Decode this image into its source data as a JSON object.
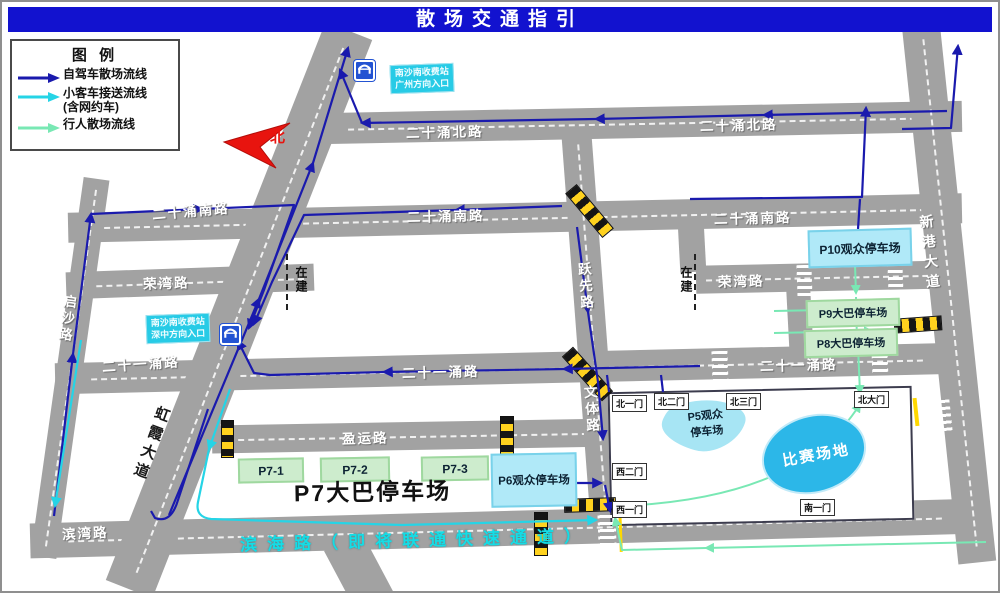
{
  "title": "散场交通指引",
  "legend": {
    "title": "图 例",
    "items": [
      {
        "label": "自驾车散场流线"
      },
      {
        "label": "小客车接送流线",
        "sublabel": "(含网约车)"
      },
      {
        "label": "行人散场流线"
      }
    ]
  },
  "north": "北",
  "tolls": {
    "guangzhou": {
      "line1": "南沙南收费站",
      "line2": "广州方向入口"
    },
    "shenzhong": {
      "line1": "南沙南收费站",
      "line2": "深中方向入口"
    }
  },
  "roads": {
    "esn_north_w": "二十涌北路",
    "esn_north_e": "二十涌北路",
    "esn_south_w": "二十涌南路",
    "esn_south_c": "二十涌南路",
    "esn_south_e": "二十涌南路",
    "rongwan_w": "荣湾路",
    "rongwan_e": "荣湾路",
    "esy_w": "二十一涌路",
    "esy_c": "二十一涌路",
    "esy_e": "二十一涌路",
    "yingyun": "盈运路",
    "binwan": "滨湾路",
    "qisha": "启沙路",
    "yuexian": "跃先路",
    "wenti": "文体路",
    "hongxia": "虹霞大道",
    "xingang": "新港大道"
  },
  "under_construction": {
    "left": "在建",
    "right": "在建"
  },
  "parking": {
    "p10": "P10观众停车场",
    "p9": "P9大巴停车场",
    "p8": "P8大巴停车场",
    "p7_title": "P7大巴停车场",
    "p7_zones": [
      "P7-1",
      "P7-2",
      "P7-3"
    ],
    "p6": "P6观众停车场",
    "p5_line1": "P5观众",
    "p5_line2": "停车场"
  },
  "venue": {
    "name": "比赛场地",
    "gates": {
      "bei1": "北一门",
      "bei2": "北二门",
      "bei3": "北三门",
      "beida": "北大门",
      "xi2": "西二门",
      "xi1": "西一门",
      "nan1": "南一门"
    }
  },
  "road_banner": "滨海路（即将联通快速通道）",
  "colors": {
    "header": "#1212cf",
    "driving": "#1a1aad",
    "shuttle": "#25d4e6",
    "pedestrian": "#79e8b4",
    "road": "#a2a2a2"
  }
}
